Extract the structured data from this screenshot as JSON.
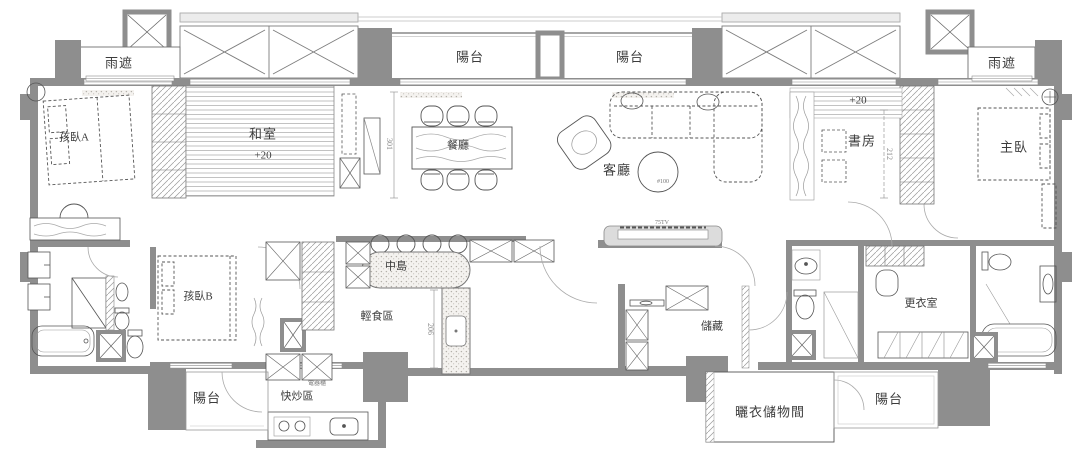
{
  "meta": {
    "drawing_type": "residential apartment floor plan",
    "language": "zh-TW"
  },
  "colors": {
    "background": "#ffffff",
    "wall_fill": "#8e8e8e",
    "line": "#4f4f4f",
    "label_text": "#3c3c3c",
    "dimension_text": "#8a8a8a"
  },
  "labels": {
    "rain_shelter_left": "雨遮",
    "rain_shelter_right": "雨遮",
    "balcony_top_left": "陽台",
    "balcony_top_right": "陽台",
    "kid_bedroom_a": "孩臥A",
    "tatami_room": "和室",
    "tatami_room_level": "+20",
    "dining_room": "餐廳",
    "living_room": "客廳",
    "study_room": "書房",
    "study_room_level": "+20",
    "master_bedroom": "主臥",
    "kid_bedroom_b": "孩臥B",
    "kitchen_island": "中島",
    "light_meal_area": "輕食區",
    "stir_fry_area": "快炒區",
    "appliance_cabinet": "電器櫃",
    "balcony_bottom_left": "陽台",
    "storage": "儲藏",
    "walk_in_closet": "更衣室",
    "laundry_storage_room": "曬衣儲物間",
    "balcony_bottom_right": "陽台"
  },
  "annotations": {
    "tv_size": "75TV",
    "coffee_table_diameter": "#100"
  },
  "dimensions": {
    "dining_axis": "301",
    "island_run": "206",
    "study_depth": "212"
  }
}
